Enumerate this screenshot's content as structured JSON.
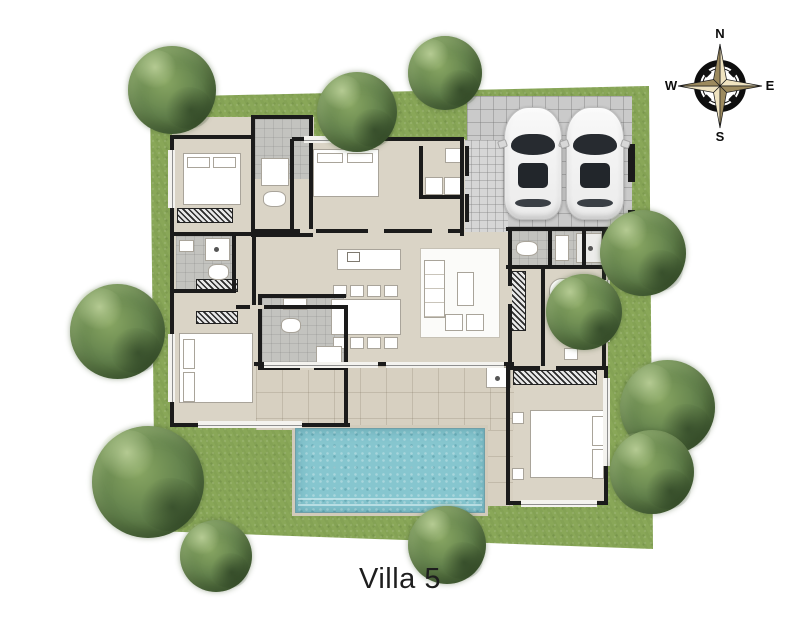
{
  "title": "Villa 5",
  "compass": {
    "north": "N",
    "east": "E",
    "south": "S",
    "west": "W"
  },
  "palette": {
    "background": "#ffffff",
    "grass": "#89a758",
    "tree_foliage": "#5d7f44",
    "pool_water": "#86c6cf",
    "interior_floor": "#dad4c6",
    "terrace_paving": "#d7d0c1",
    "carport_paving": "#cacaca",
    "bathroom_tile": "#c3c3bf",
    "wall": "#1b1b1b",
    "furniture": "#ffffff",
    "car_body": "#f4f4f4",
    "compass_gold_light": "#efe3c0",
    "compass_gold_dark": "#9c8a5e"
  }
}
